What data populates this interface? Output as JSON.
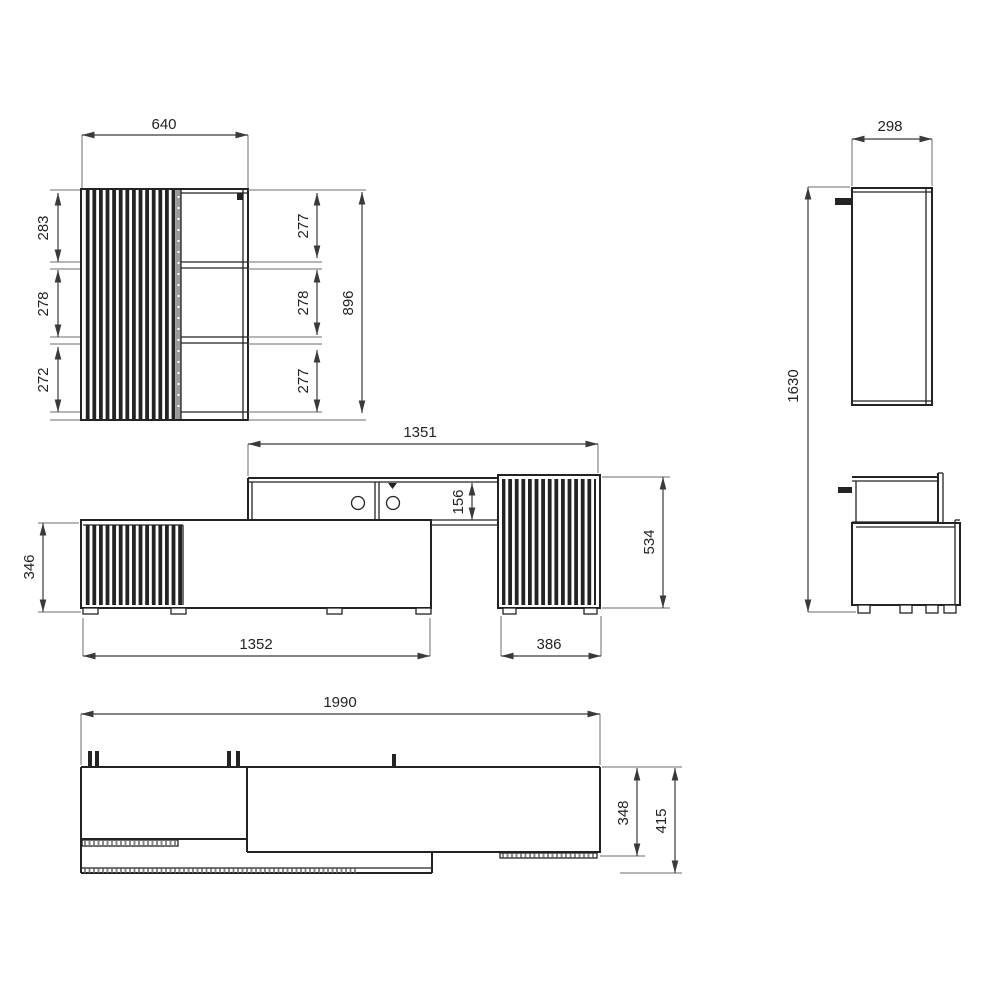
{
  "document_type": "furniture-dimension-drawing",
  "colors": {
    "line": "#232323",
    "dim": "#3a3a3a",
    "ext": "#6e6e6e",
    "hatch": "#8a8a8a",
    "background": "#ffffff"
  },
  "views": {
    "cabinet_front": {
      "name": "wall cabinet front view",
      "dims": {
        "width": "640",
        "left_top": "283",
        "left_middle": "278",
        "left_bottom": "272",
        "right_top": "277",
        "right_middle": "278",
        "right_bottom": "277",
        "height": "896"
      }
    },
    "cabinet_side": {
      "name": "cabinet side view",
      "dims": {
        "depth": "298",
        "height": "1630"
      }
    },
    "wall_unit": {
      "name": "tv bench front view",
      "dims": {
        "shelf_width": "1351",
        "shelf_height": "156",
        "bench_height": "346",
        "bench_width": "1352",
        "side_cabinet_width": "386",
        "side_cabinet_height": "534"
      }
    },
    "plan": {
      "name": "plan (top) view",
      "dims": {
        "total_width": "1990",
        "body_depth": "348",
        "total_depth": "415"
      }
    }
  }
}
